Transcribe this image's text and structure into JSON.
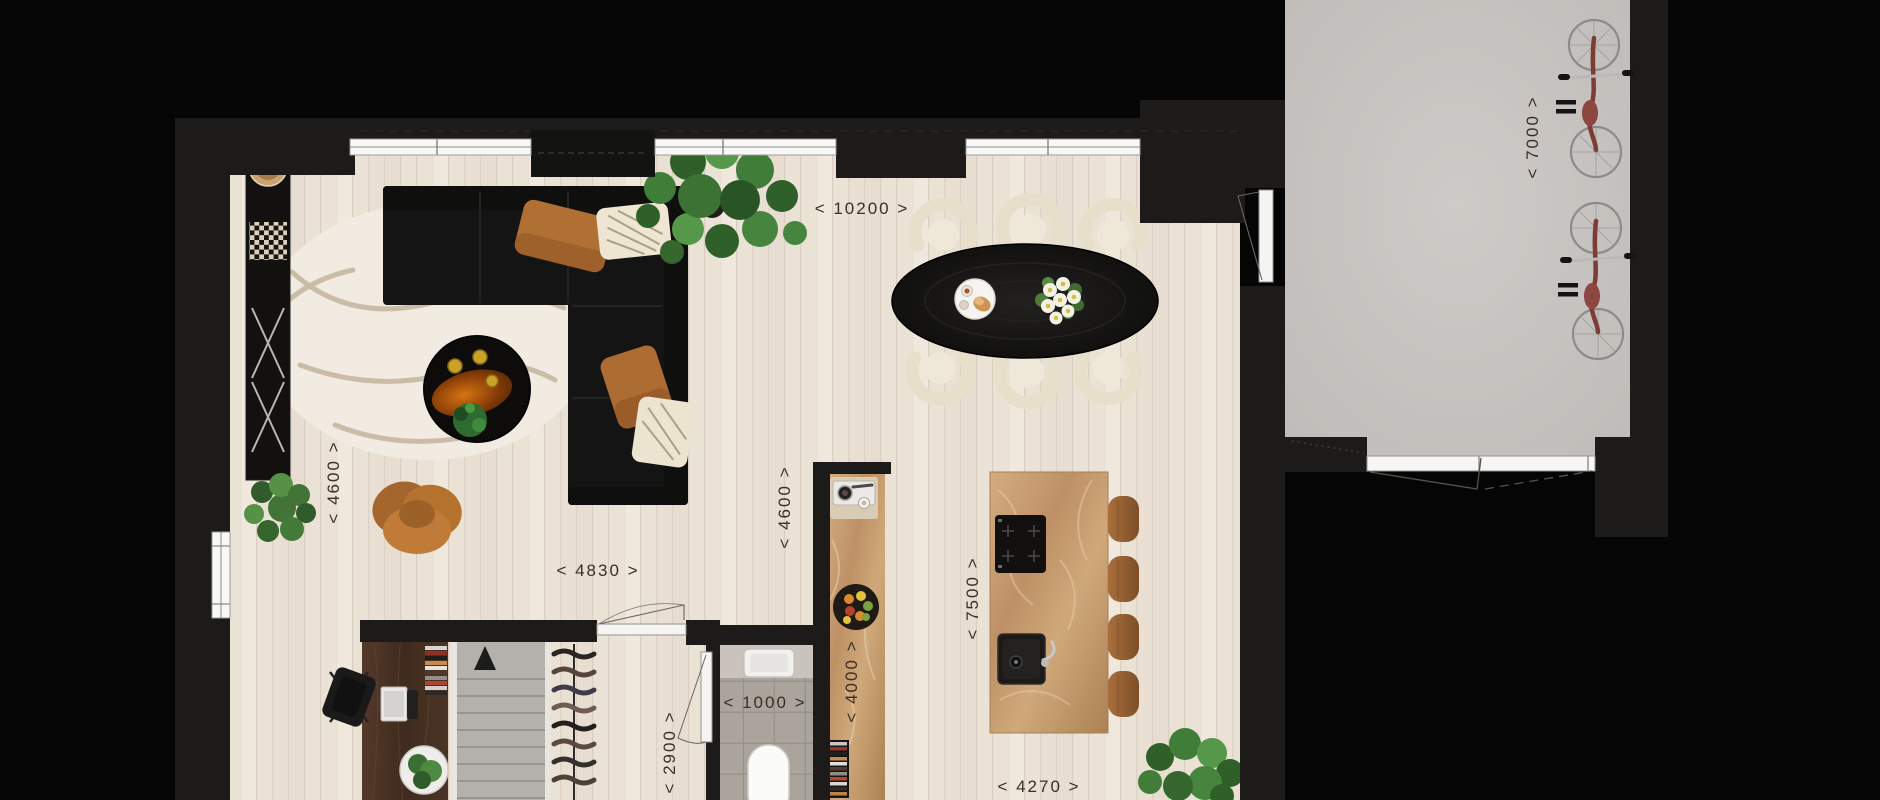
{
  "floor_plan": {
    "dimension_labels": {
      "living_width": "< 10200 >",
      "living_depth": "< 4600 >",
      "lounge_width": "< 4830 >",
      "hall_depth": "< 4600 >",
      "wc_width": "< 1000 >",
      "storage_depth": "< 2900 >",
      "counter_run": "< 4000 >",
      "kitchen_depth": "< 7500 >",
      "kitchen_width": "< 4270 >",
      "garage_depth": "< 7000 >"
    },
    "colors": {
      "background": "#050505",
      "wall": "#1d1b19",
      "wood_floor": "#ebe2d6",
      "garage_floor": "#c9c5c2",
      "tile_floor": "#aba49d",
      "marble": "#c49a6c",
      "rug": "#f1ebe1",
      "sofa": "#141414",
      "accent_cushion": "#b06f33",
      "dimension_text": "#3b2e23"
    },
    "furniture_icons": [
      "sofa",
      "rug",
      "coffee-table",
      "armchair",
      "sideboard",
      "monstera-plant",
      "dining-table",
      "dining-chair",
      "kitchen-island",
      "bar-stool",
      "induction-hob",
      "kitchen-sink",
      "wall-counter",
      "espresso-machine",
      "fruit-bowl",
      "bookshelf",
      "desk",
      "laptop",
      "office-chair",
      "staircase",
      "coat-rack",
      "toilet",
      "bicycle",
      "garage-door",
      "window",
      "door"
    ]
  }
}
